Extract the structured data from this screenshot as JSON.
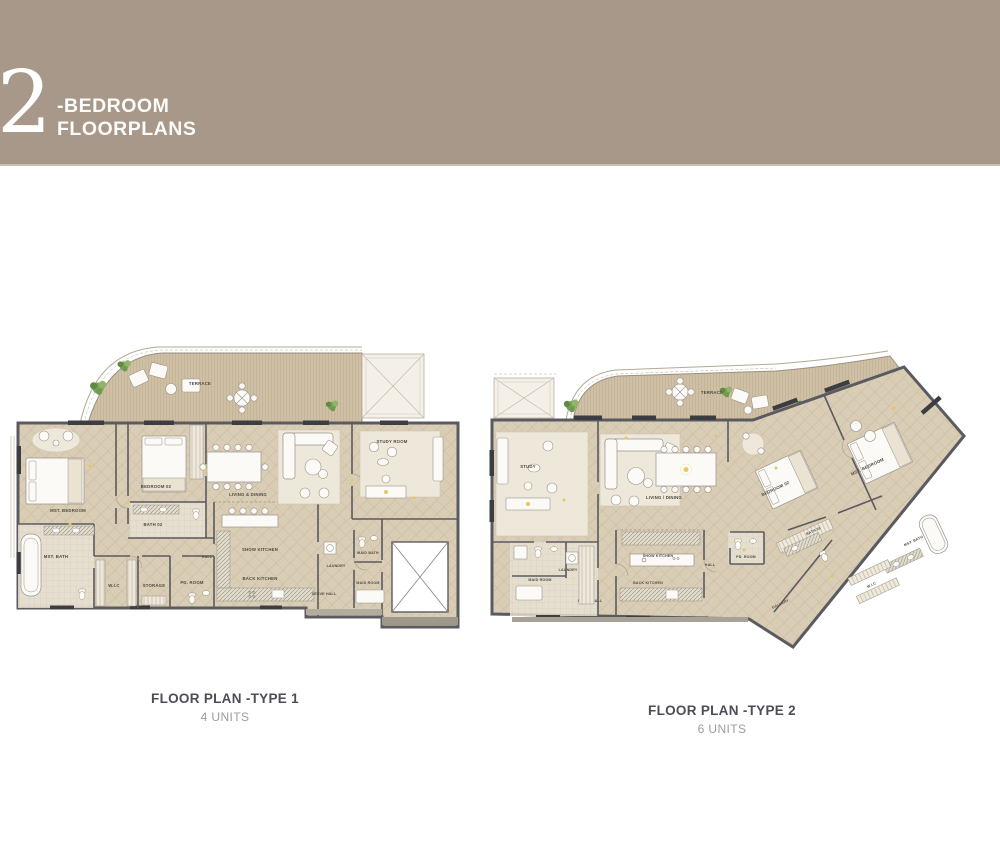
{
  "header": {
    "number": "2",
    "title_line1": "-BEDROOM",
    "title_line2": "FLOORPLANS",
    "bg_color": "#a89889",
    "text_color": "#ffffff"
  },
  "plans": [
    {
      "caption": "FLOOR PLAN -TYPE 1",
      "units": "4 UNITS",
      "rooms": {
        "terrace": "TERRACE",
        "mst_bedroom": "MST. BEDROOM",
        "bedroom02": "BEDROOM 02",
        "living": "LIVING & DINING",
        "study": "STUDY ROOM",
        "bath02": "BATH 02",
        "mst_bath": "MST. BATH",
        "wic": "W.I.C",
        "storage": "STORAGE",
        "pd_room": "PD. ROOM",
        "hall": "HALL",
        "show_kitchen": "SHOW KITCHEN",
        "back_kitchen": "BACK KITCHEN",
        "serve_hall": "SERVE HALL",
        "laundry": "LAUNDRY",
        "maid_bath": "MAID BATH",
        "maid_room": "MAID ROOM"
      }
    },
    {
      "caption": "FLOOR PLAN -TYPE 2",
      "units": "6 UNITS",
      "rooms": {
        "terrace": "TERRACE",
        "study": "STUDY",
        "living": "LIVING / DINING",
        "bedroom02": "BEDROOM 02",
        "mst_bedroom": "MST. BEDROOM",
        "bath02": "BATH 02",
        "mst_bath": "MST. BATH",
        "wic": "W.I.C",
        "gallery": "GALLERY",
        "hall": "HALL",
        "pd_room": "PD. ROOM",
        "show_kitchen": "SHOW KITCHEN",
        "back_kitchen": "BACK KITCHEN",
        "serve_hall": "SERVE HALL",
        "laundry": "LAUNDRY",
        "maid_room": "MAID ROOM"
      }
    }
  ]
}
